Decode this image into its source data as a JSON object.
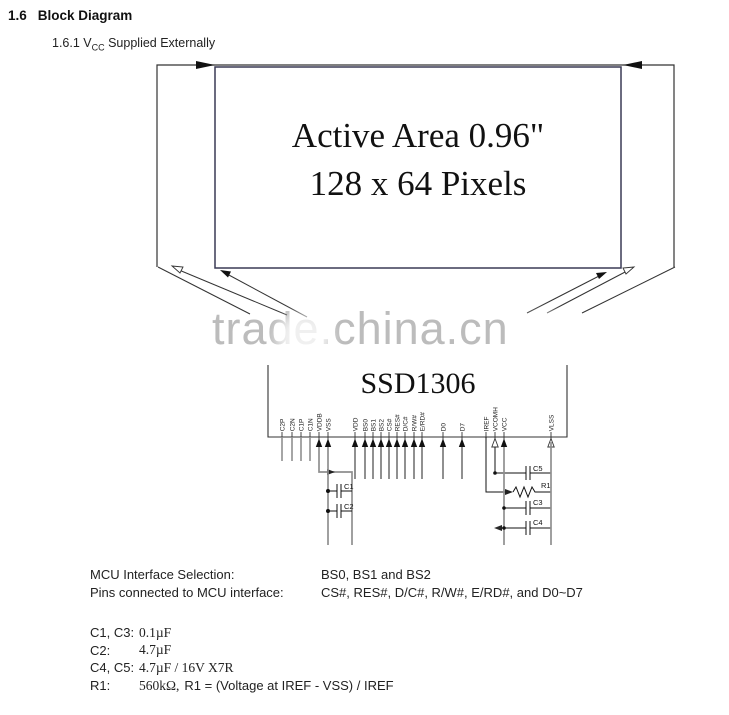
{
  "heading": {
    "number": "1.6",
    "title": "Block Diagram"
  },
  "subheading": {
    "prefix": "1.6.1 V",
    "sub": "CC",
    "suffix": " Supplied Externally"
  },
  "watermark": {
    "text": "trade.china.cn",
    "color": "#b5b5b5"
  },
  "panel": {
    "line1": "Active Area 0.96\"",
    "line2": "128 x 64 Pixels"
  },
  "chip": {
    "name": "SSD1306",
    "pins": [
      "C2P",
      "C2N",
      "C1P",
      "C1N",
      "VDDB",
      "VSS",
      "VDD",
      "BS0",
      "BS1",
      "BS2",
      "CS#",
      "RES#",
      "D/C#",
      "R/W#",
      "E/RD#",
      "D0",
      "D7",
      "IREF",
      "VCOMH",
      "VCC",
      "VLSS"
    ]
  },
  "component_labels": {
    "c1": "C1",
    "c2": "C2",
    "c3": "C3",
    "c4": "C4",
    "c5": "C5",
    "r1": "R1"
  },
  "notes": {
    "rows": [
      {
        "label": "MCU Interface Selection:",
        "value": "BS0, BS1 and BS2"
      },
      {
        "label": "Pins connected to MCU interface:",
        "value": "CS#, RES#, D/C#, R/W#, E/RD#, and D0~D7"
      }
    ],
    "bom": [
      {
        "ref": "C1, C3:",
        "value": "0.1µF",
        "value2": ""
      },
      {
        "ref": "C2:",
        "value": "4.7µF",
        "value2": ""
      },
      {
        "ref": "C4, C5:",
        "value": "4.7µF / 16V X7R",
        "value2": ""
      },
      {
        "ref": "R1:",
        "value": "560kΩ,",
        "value2": "R1 = (Voltage at IREF - VSS) / IREF"
      }
    ]
  },
  "colors": {
    "line": "#333333",
    "rail": "#8f8f8f",
    "box_border": "#3a3a55"
  }
}
